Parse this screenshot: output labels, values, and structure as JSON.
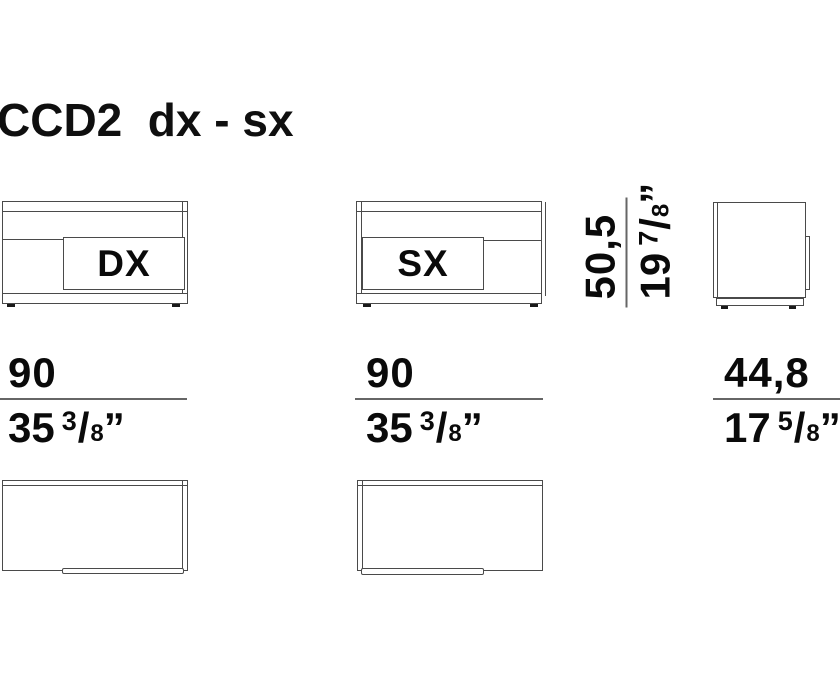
{
  "title": "CCD2  dx - sx",
  "front_views": {
    "dx": {
      "label": "DX"
    },
    "sx": {
      "label": "SX"
    }
  },
  "dimensions": {
    "height": {
      "metric": "50,5",
      "whole": "19",
      "num": "7",
      "den": "8",
      "slash": "/",
      "mark": "”"
    },
    "width_dx": {
      "metric": "90",
      "whole": "35",
      "num": "3",
      "den": "8",
      "slash": "/",
      "mark": "”"
    },
    "width_sx": {
      "metric": "90",
      "whole": "35",
      "num": "3",
      "den": "8",
      "slash": "/",
      "mark": "”"
    },
    "depth": {
      "metric": "44,8",
      "whole": "17",
      "num": "5",
      "den": "8",
      "slash": "/",
      "mark": "”"
    }
  },
  "colors": {
    "background": "#ffffff",
    "line": "#4a4a4a",
    "dim_rule": "#666666",
    "text": "#0a0a0a"
  }
}
